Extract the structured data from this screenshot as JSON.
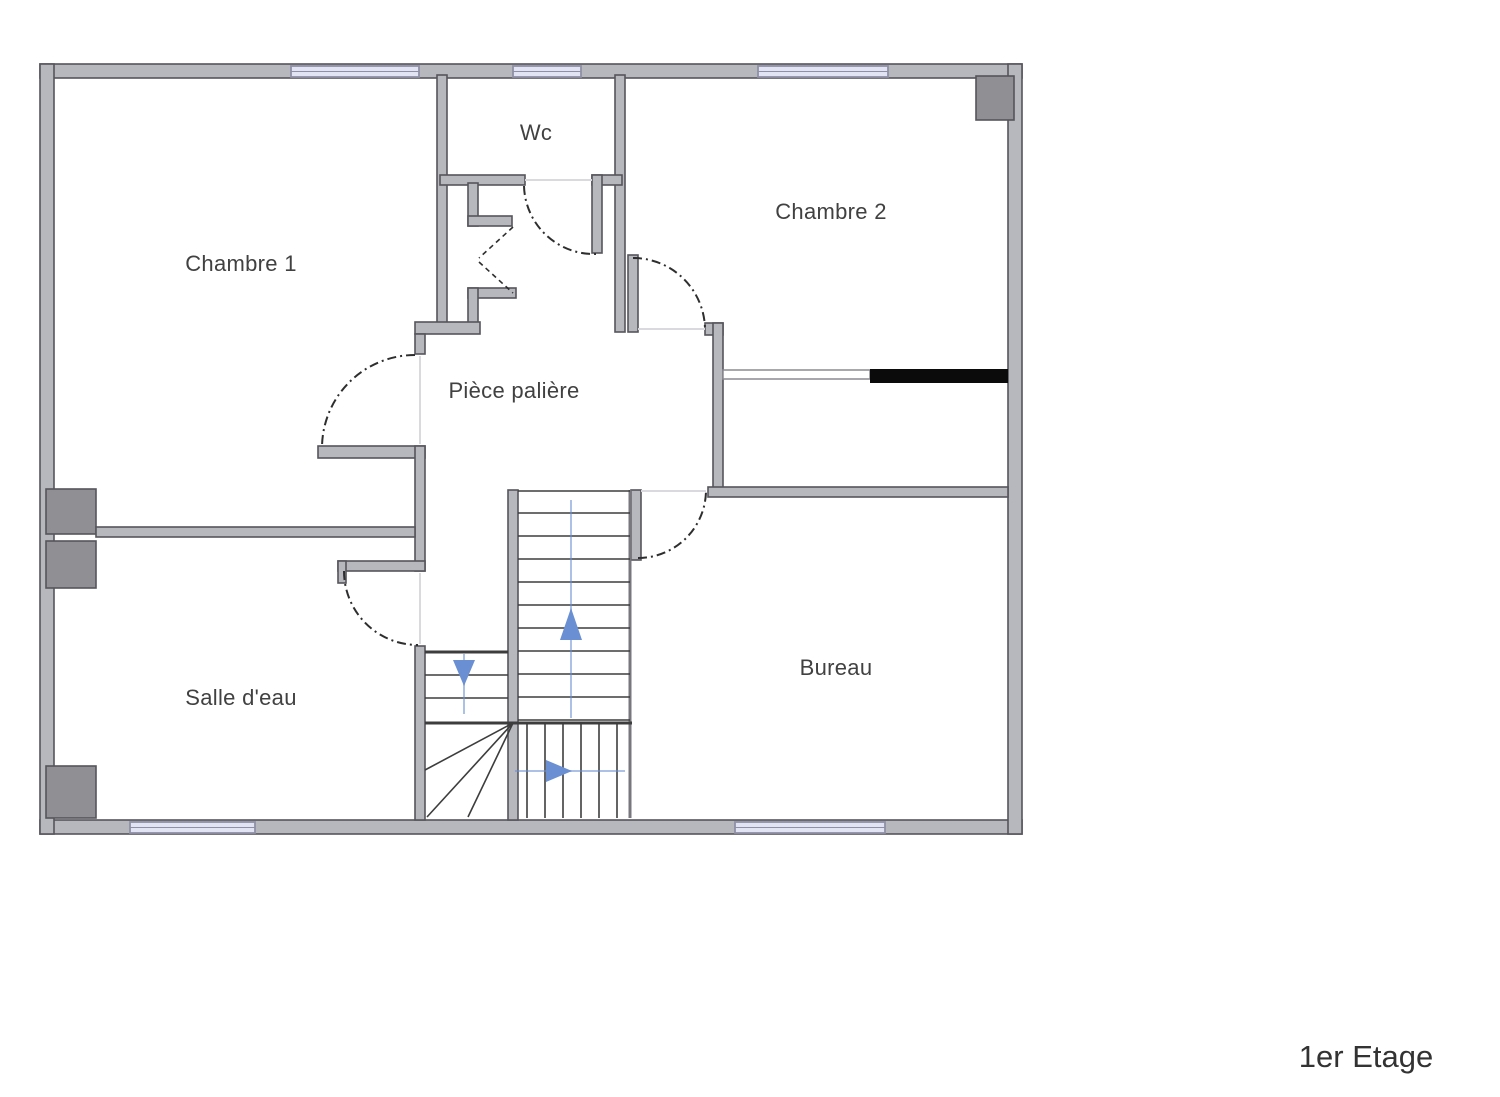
{
  "floor_plan": {
    "title": "1er Etage",
    "rooms": [
      {
        "id": "chambre-1",
        "label": "Chambre 1"
      },
      {
        "id": "wc",
        "label": "Wc"
      },
      {
        "id": "chambre-2",
        "label": "Chambre 2"
      },
      {
        "id": "piece-paliere",
        "label": "Pièce palière"
      },
      {
        "id": "salle-d-eau",
        "label": "Salle d'eau"
      },
      {
        "id": "bureau",
        "label": "Bureau"
      }
    ],
    "stairs": {
      "arrow_directions": [
        "up",
        "down",
        "right"
      ]
    },
    "window_count": 5,
    "colors": {
      "wall-fill": "#b7b7be",
      "wall-stroke": "#55555b",
      "window-fill": "#e2e3f3",
      "window-stroke": "#8f90a6",
      "square-fill": "#8f8f94",
      "door-stroke": "#2e2e2e",
      "stair-stroke": "#3d3d3d",
      "arrow-blue": "#6a8fd2",
      "black-bar": "#0b0b0b",
      "label-color": "#414141",
      "title-color": "#333333"
    }
  }
}
